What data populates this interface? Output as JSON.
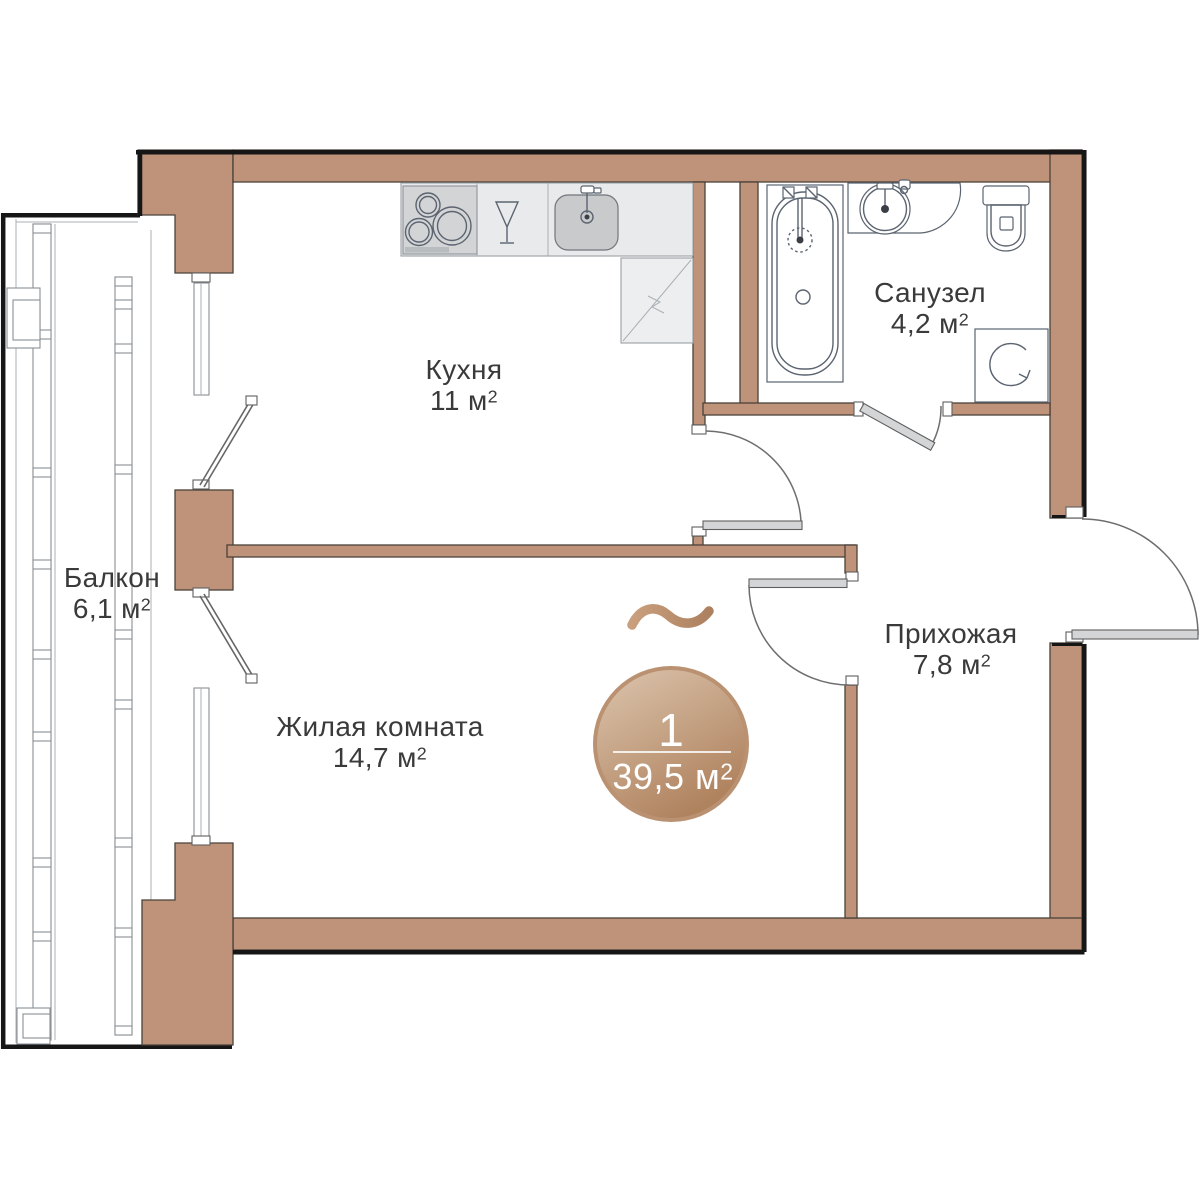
{
  "plan": {
    "rooms": [
      {
        "id": "kitchen",
        "name": "Кухня",
        "area": "11 м²"
      },
      {
        "id": "bathroom",
        "name": "Санузел",
        "area": "4,2 м²"
      },
      {
        "id": "hallway",
        "name": "Прихожая",
        "area": "7,8 м²"
      },
      {
        "id": "living_room",
        "name": "Жилая комната",
        "area": "14,7 м²"
      },
      {
        "id": "balcony",
        "name": "Балкон",
        "area": "6,1 м²"
      }
    ],
    "badge": {
      "rooms_count": "1",
      "total_area": "39,5 м²"
    },
    "icons": [
      "hob-icon",
      "wine-glass-icon",
      "kitchen-sink-icon",
      "corner-cabinet-icon",
      "bathtub-icon",
      "washbasin-icon",
      "toilet-icon",
      "washing-machine-icon",
      "tilde-icon"
    ]
  },
  "colors": {
    "wall": "#BF937A",
    "wall-edge": "#4A413A",
    "outer": "#161616",
    "leaf": "#D4D5D7",
    "fx": "#5B6470",
    "counter": "#E9EAEB",
    "stove": "#D3D4D6",
    "sink-basin": "#C9CACC",
    "text": "#3A3A3A",
    "badge-hi": "#DCC5AE",
    "badge-lo": "#B0835F",
    "badge-ring": "#BA9171",
    "tilde-hi": "#C99F7D",
    "tilde-lo": "#AD8160",
    "cabinet": "#EDEEEF"
  }
}
